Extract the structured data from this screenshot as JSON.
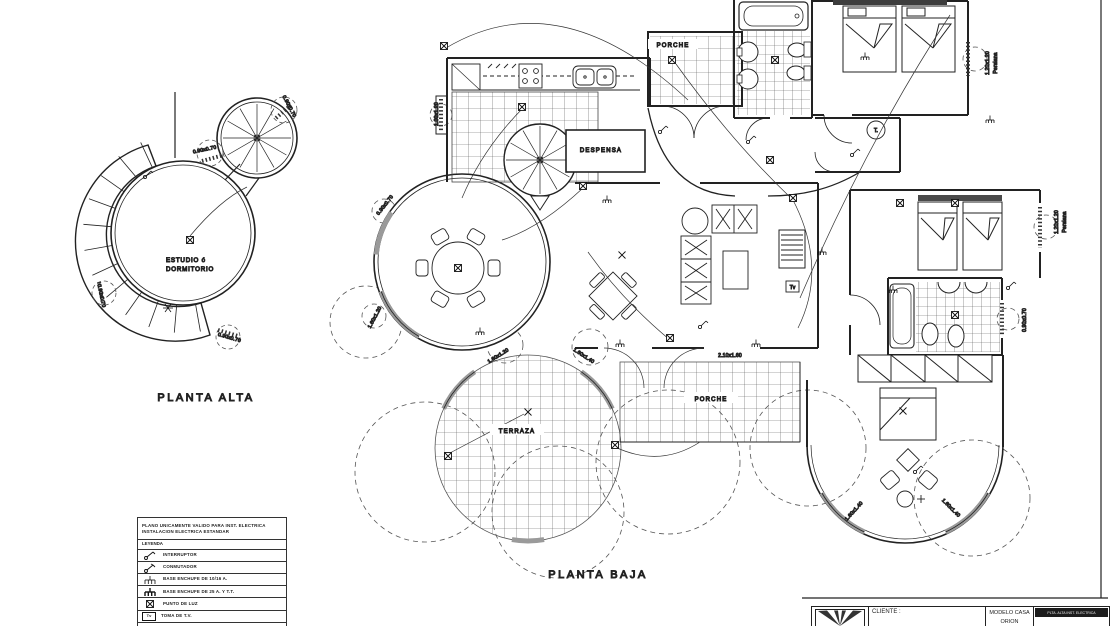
{
  "captions": {
    "planta_alta": "PLANTA ALTA",
    "planta_baja": "PLANTA BAJA"
  },
  "upper_floor": {
    "room_line1": "ESTUDIO ó",
    "room_line2": "DORMITORIO"
  },
  "rooms": {
    "porche_top": "PORCHE",
    "despensa": "DESPENSA",
    "terraza": "TERRAZA",
    "porche_mid": "PORCHE"
  },
  "labels": {
    "tel": "T.",
    "tv": "Tv"
  },
  "dims": {
    "d_090_070": "0.90x0.70",
    "d_100_120": "1.00x1.20",
    "d_160_120": "1.60x1.20",
    "d_160_140": "1.60x1.40",
    "d_210_160": "2.10x1.60",
    "d_120_120": "1.20x1.20",
    "persiana": "Persiana"
  },
  "legend": {
    "note1": "PLANO UNICAMENTE VALIDO PARA INST. ELECTRICA",
    "note2": "INSTALACION ELECTRICA ESTANDAR",
    "heading": "LEYENDA",
    "items": [
      {
        "symbol": "interruptor-symbol",
        "label": "INTERRUPTOR"
      },
      {
        "symbol": "conmutador-symbol",
        "label": "CONMUTADOR"
      },
      {
        "symbol": "enchufe-10-16-symbol",
        "label": "BASE ENCHUFE DE 10/16 A."
      },
      {
        "symbol": "enchufe-25-symbol",
        "label": "BASE ENCHUFE DE 25 A. Y T.T."
      },
      {
        "symbol": "punto-de-luz-symbol",
        "label": "PUNTO DE LUZ"
      },
      {
        "symbol": "toma-tv-symbol",
        "label": "TOMA DE T.V.",
        "symbol_text": "Tv"
      }
    ]
  },
  "titleblock": {
    "cliente": "CLIENTE :",
    "modelo1": "MODELO CASA",
    "modelo2": "ORION",
    "stamp": "PLTA. ALTA INST. ELECTRICA"
  }
}
